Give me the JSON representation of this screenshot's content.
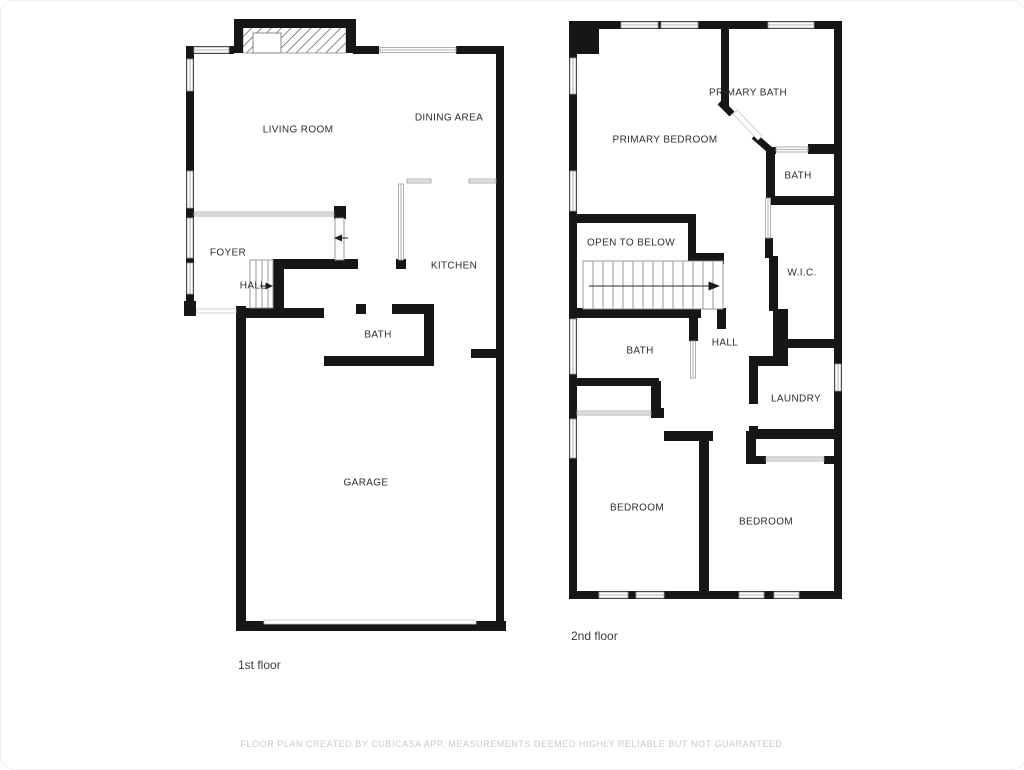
{
  "colors": {
    "wall": "#161616",
    "thin": "#9c9c9c",
    "stair": "#8f8f8f",
    "door_faint": "#c6c6c6",
    "label": "#2e2e2e",
    "floor_label": "#3c3c3c",
    "disclaimer": "#c9c9c9"
  },
  "floor1": {
    "label": "1st floor",
    "rooms": {
      "living_room": "LIVING ROOM",
      "dining_area": "DINING AREA",
      "foyer": "FOYER",
      "hall": "HALL",
      "kitchen": "KITCHEN",
      "bath": "BATH",
      "garage": "GARAGE"
    }
  },
  "floor2": {
    "label": "2nd floor",
    "rooms": {
      "primary_bedroom": "PRIMARY BEDROOM",
      "primary_bath": "PRIMARY BATH",
      "bath_top": "BATH",
      "wic": "W.I.C.",
      "open_to_below": "OPEN TO BELOW",
      "hall": "HALL",
      "bath_mid": "BATH",
      "laundry": "LAUNDRY",
      "bedroom_left": "BEDROOM",
      "bedroom_right": "BEDROOM"
    }
  },
  "footer": {
    "disclaimer": "FLOOR PLAN CREATED BY CUBICASA APP. MEASUREMENTS DEEMED HIGHLY RELIABLE BUT NOT GUARANTEED."
  }
}
